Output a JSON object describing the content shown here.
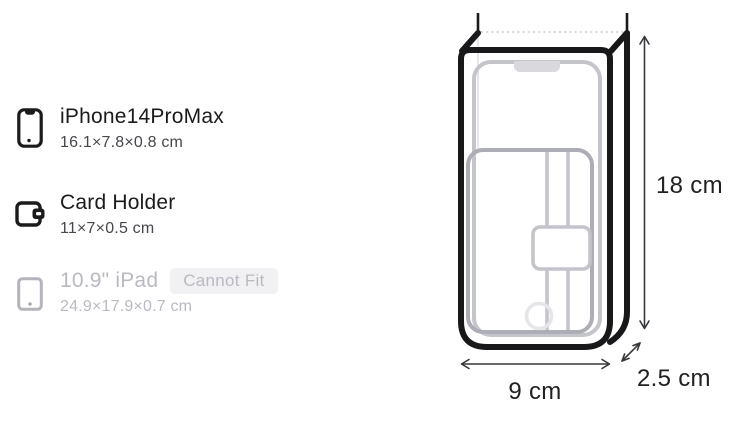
{
  "fit_list": {
    "items": [
      {
        "label": "iPhone14ProMax",
        "dimensions": "16.1×7.8×0.8 cm",
        "fits": true,
        "icon": "smartphone-icon"
      },
      {
        "label": "Card Holder",
        "dimensions": "11×7×0.5 cm",
        "fits": true,
        "icon": "wallet-icon"
      },
      {
        "label": "10.9\" iPad",
        "dimensions": "24.9×17.9×0.7 cm",
        "fits": false,
        "icon": "tablet-icon",
        "badge": "Cannot Fit"
      }
    ]
  },
  "diagram": {
    "height_label": "18 cm",
    "width_label": "9 cm",
    "depth_label": "2.5 cm"
  },
  "colors": {
    "title_text": "#1b1b1d",
    "dimension_text": "#47474c",
    "disabled_text": "#b9b9c2",
    "badge_background": "#f1f1f4",
    "bag_outline": "#18181a",
    "phone_ghost": "#c4c4cb",
    "card_ghost": "#adadb6",
    "arrow": "#38383c"
  }
}
